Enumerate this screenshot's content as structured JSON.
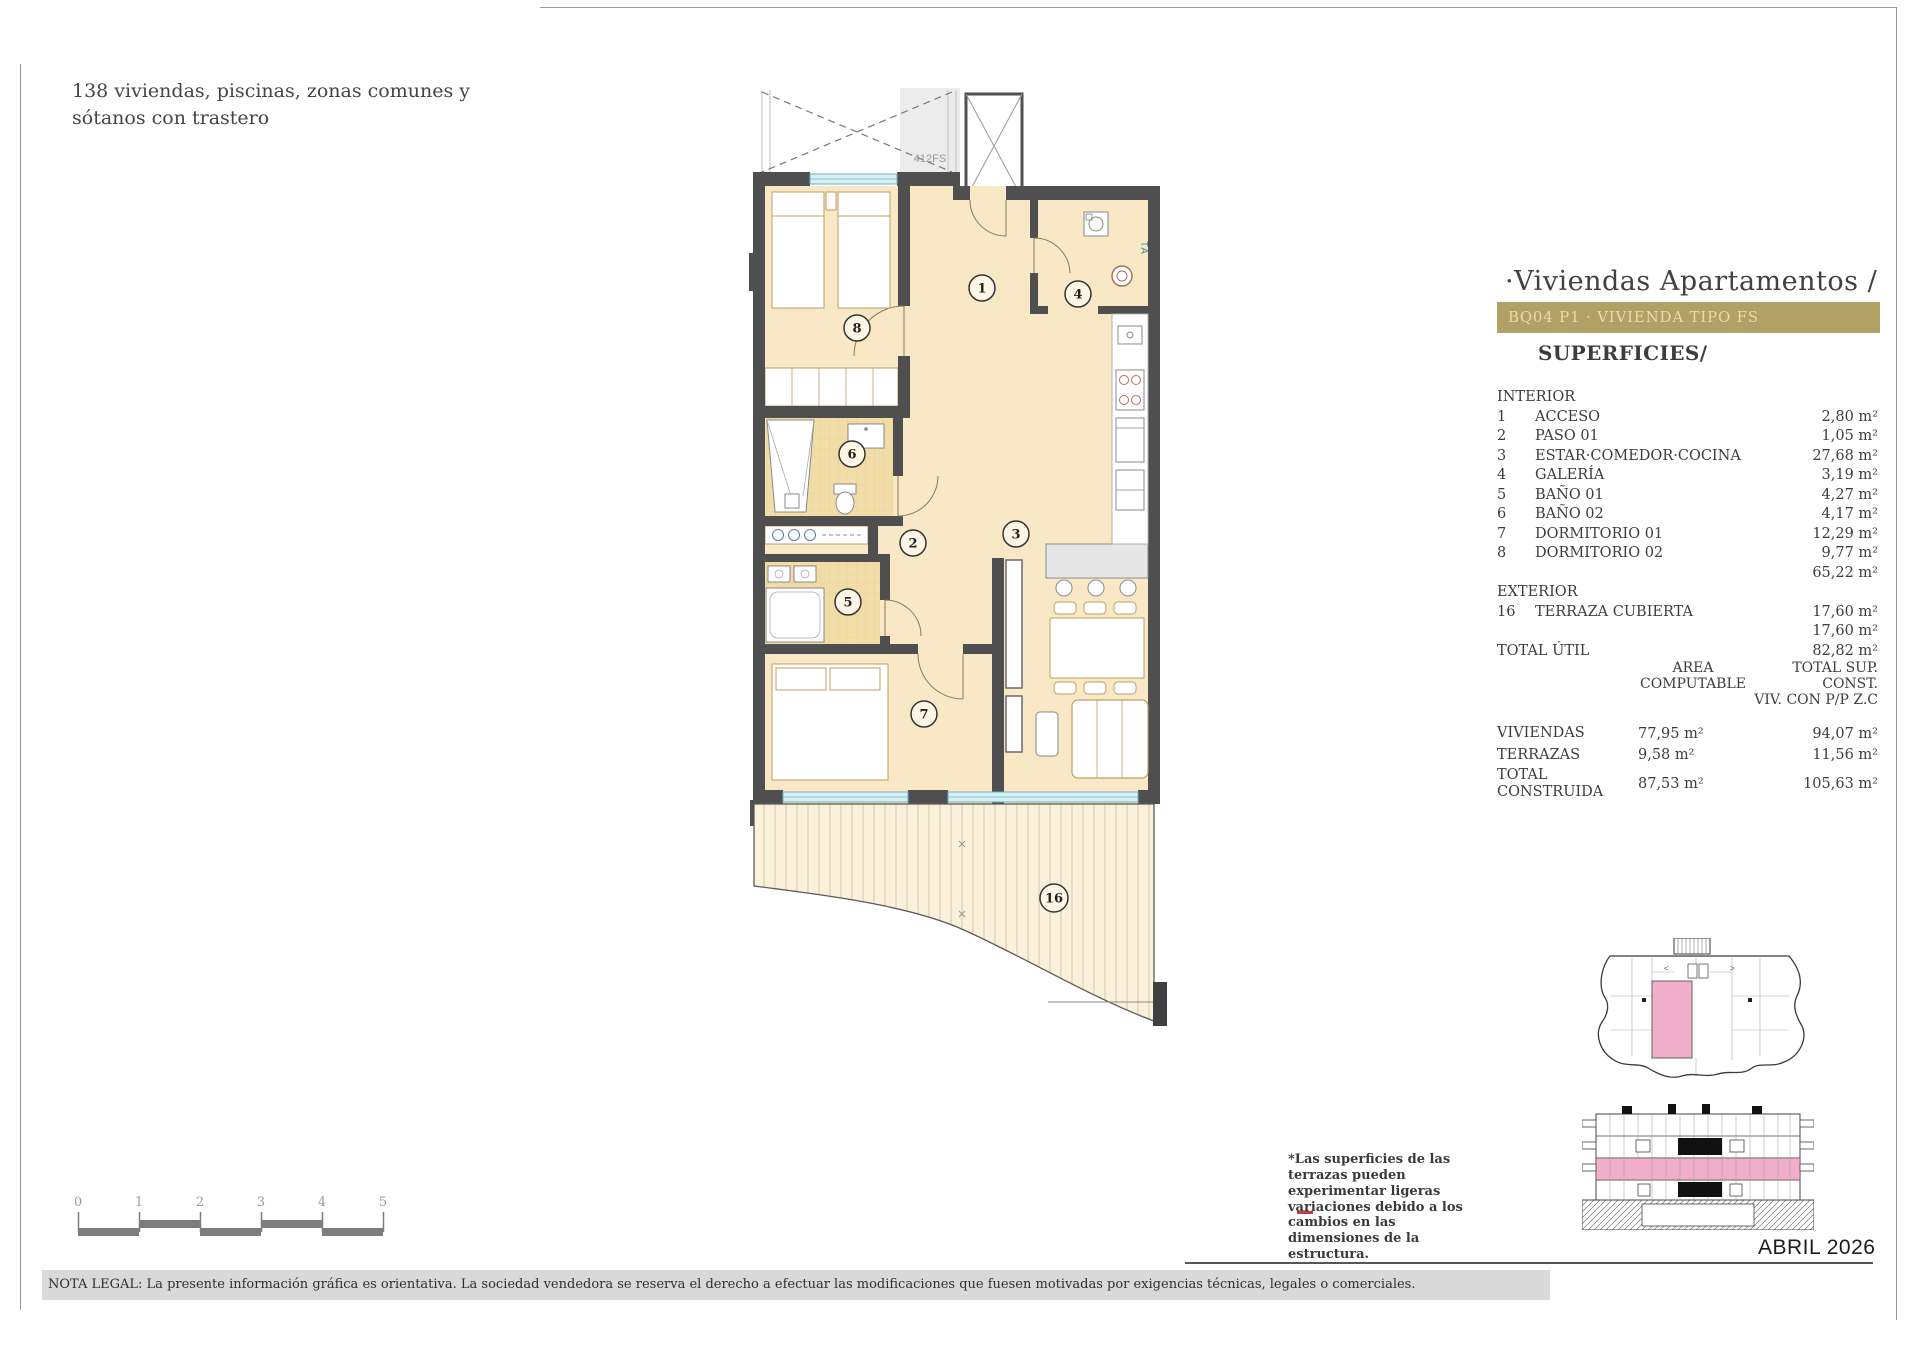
{
  "header": {
    "project_note": "138 viviendas, piscinas, zonas comunes y sótanos con trastero"
  },
  "panel": {
    "title": "·Viviendas Apartamentos /",
    "type_banner": "BQ04 P1 · VIVIENDA TIPO FS",
    "section_title": "SUPERFICIES/",
    "interior_label": "INTERIOR",
    "interior_rows": [
      {
        "num": "1",
        "name": "ACCESO",
        "value": "2,80 m²"
      },
      {
        "num": "2",
        "name": "PASO 01",
        "value": "1,05 m²"
      },
      {
        "num": "3",
        "name": "ESTAR·COMEDOR·COCINA",
        "value": "27,68 m²"
      },
      {
        "num": "4",
        "name": "GALERÍA",
        "value": "3,19 m²"
      },
      {
        "num": "5",
        "name": "BAÑO 01",
        "value": "4,27 m²"
      },
      {
        "num": "6",
        "name": "BAÑO 02",
        "value": "4,17 m²"
      },
      {
        "num": "7",
        "name": "DORMITORIO 01",
        "value": "12,29 m²"
      },
      {
        "num": "8",
        "name": "DORMITORIO 02",
        "value": "9,77 m²"
      }
    ],
    "interior_subtotal": "65,22 m²",
    "exterior_label": "EXTERIOR",
    "exterior_row": {
      "num": "16",
      "name": "TERRAZA CUBIERTA",
      "value": "17,60 m²"
    },
    "exterior_subtotal": "17,60 m²",
    "total_util_label": "TOTAL ÚTIL",
    "total_util_value": "82,82 m²",
    "summary": {
      "col1_header_line1": "AREA",
      "col1_header_line2": "COMPUTABLE",
      "col2_header_line1": "TOTAL SUP. CONST.",
      "col2_header_line2": "VIV. CON P/P Z.C",
      "rows": [
        {
          "label": "VIVIENDAS",
          "area": "77,95 m²",
          "total": "94,07 m²"
        },
        {
          "label": "TERRAZAS",
          "area": "9,58 m²",
          "total": "11,56 m²"
        },
        {
          "label": "TOTAL CONSTRUIDA",
          "area": "87,53 m²",
          "total": "105,63 m²"
        }
      ]
    },
    "terrace_note": "*Las superficies de las terrazas pueden experimentar ligeras variaciones debido a los cambios en las dimensiones de la estructura."
  },
  "plan": {
    "unit_label": "412FS",
    "appliance_label": "TA",
    "room_numbers": {
      "acceso": "1",
      "paso": "2",
      "estar": "3",
      "galeria": "4",
      "bano1": "5",
      "bano2": "6",
      "dorm1": "7",
      "dorm2": "8",
      "terraza": "16"
    }
  },
  "scale_bar": {
    "numbers": [
      "0",
      "1",
      "2",
      "3",
      "4",
      "5"
    ]
  },
  "footer": {
    "legal_note": "NOTA LEGAL: La presente información gráfica es orientativa. La sociedad vendedora se reserva el derecho a efectuar las modificaciones que fuesen motivadas por exigencias técnicas, legales o comerciales.",
    "date": "ABRIL 2026"
  },
  "colors": {
    "banner_gold": "#b2a164",
    "highlight_pink": "#f1aecb",
    "wall": "#4f4f4f",
    "room_cream": "#f8e8c6",
    "wet_room": "#f2dca8",
    "window": "#d6eff5"
  }
}
